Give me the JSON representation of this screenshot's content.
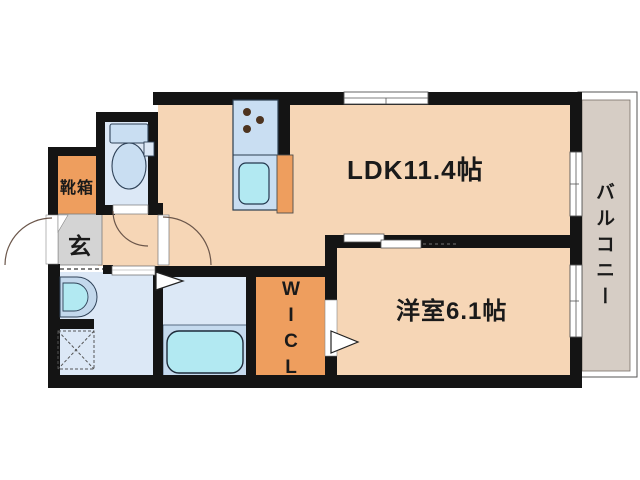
{
  "plan": {
    "rooms": {
      "ldk_label": "LDK11.4帖",
      "bedroom_label": "洋室6.1帖",
      "balcony_label": "バルコニー",
      "entrance_label": "玄",
      "shoe_box_label": "靴箱",
      "wicl_lines": [
        "W",
        "I",
        "C",
        "L"
      ]
    },
    "colors": {
      "wall": "#141414",
      "room_floor": "#f6d6b6",
      "closet_orange": "#ee9e5e",
      "entrance_gray": "#d4d4d4",
      "balcony_floor": "#d6cdc5",
      "wet_room_blue": "#dce8f6",
      "fixture_blue": "#c9def2",
      "basin_cyan": "#b2e9f2",
      "bath_platform_blue": "#c5daee"
    }
  }
}
